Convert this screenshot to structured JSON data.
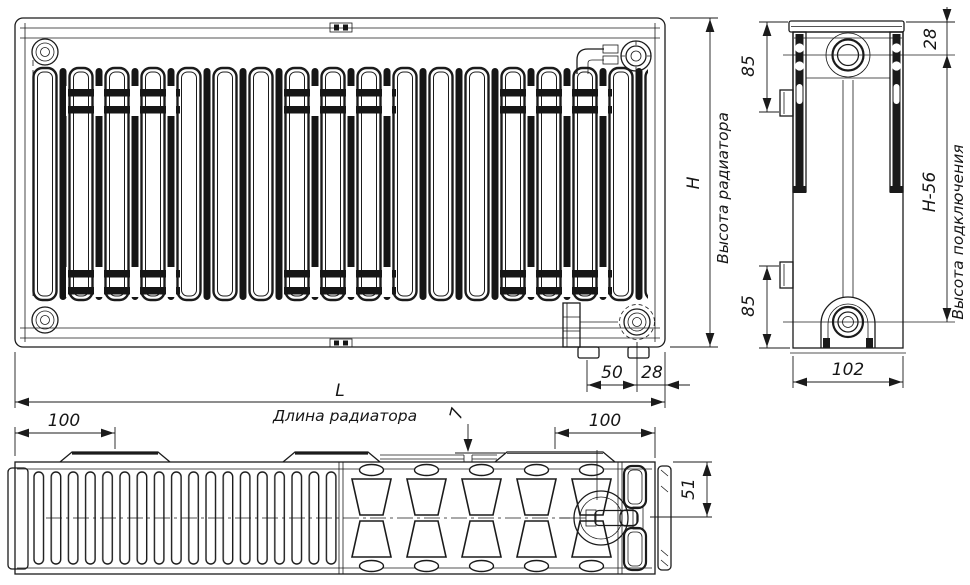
{
  "title": "Radiator technical drawing",
  "colors": {
    "ink": "#1b1b1b",
    "background": "#ffffff"
  },
  "views": {
    "front": {
      "dims": {
        "height_letter": "H",
        "height_label": "Высота радиатора",
        "bottom_50": "50",
        "bottom_28": "28",
        "length_letter": "L",
        "length_label": "Длина радиатора"
      }
    },
    "side": {
      "dims": {
        "top_28": "28",
        "top_85": "85",
        "bottom_85": "85",
        "connection": "H-56",
        "connection_label": "Высота подключения",
        "depth_102": "102"
      }
    },
    "bottom": {
      "dims": {
        "left_100": "100",
        "right_100": "100",
        "gap_7": "7",
        "half_depth_51": "51"
      }
    }
  }
}
